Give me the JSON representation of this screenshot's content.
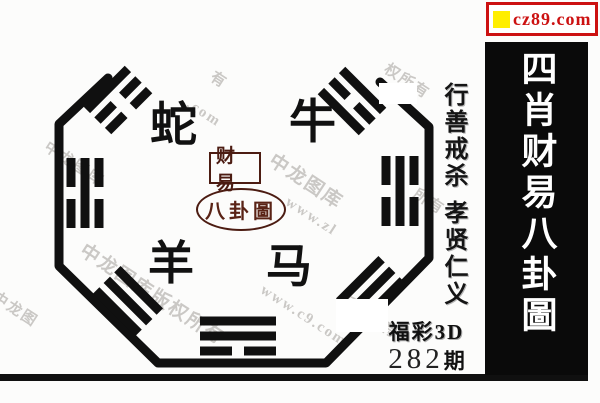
{
  "banner": {
    "site": "cz89.com"
  },
  "title_strip": {
    "text": "四肖财易八卦圖"
  },
  "motto": {
    "part1": "行善戒杀",
    "part2": "孝贤仁义"
  },
  "zodiac": {
    "snake": "蛇",
    "ox": "牛",
    "goat": "羊",
    "horse": "马"
  },
  "seal": {
    "box": "财易",
    "oval": "八卦圖"
  },
  "issue": {
    "game": "福彩3D",
    "number": "282",
    "unit": "期"
  },
  "trigrams": {
    "top_left": [
      "solid",
      "broken",
      "broken"
    ],
    "top_right": [
      "solid",
      "broken",
      "solid"
    ],
    "left_middle": [
      "broken",
      "solid",
      "broken"
    ],
    "right_middle": [
      "broken",
      "solid",
      "broken"
    ],
    "bottom_left": [
      "solid",
      "solid",
      "solid"
    ],
    "bottom_middle": [
      "solid",
      "solid",
      "broken"
    ],
    "bottom_right": [
      "solid",
      "solid",
      "solid"
    ]
  },
  "watermarks": [
    {
      "text": "中龙图库",
      "x": 52,
      "y": 136,
      "big": false
    },
    {
      "text": "有",
      "x": 218,
      "y": 66,
      "big": false
    },
    {
      "text": ".com",
      "x": 192,
      "y": 96,
      "big": false
    },
    {
      "text": "权所有",
      "x": 392,
      "y": 58,
      "big": false
    },
    {
      "text": "中龙图库",
      "x": 279,
      "y": 146,
      "big": true
    },
    {
      "text": "www.zl",
      "x": 291,
      "y": 194,
      "big": false
    },
    {
      "text": "所有",
      "x": 421,
      "y": 183,
      "big": false
    },
    {
      "text": "中龙图库版权所有",
      "x": 90,
      "y": 236,
      "big": true
    },
    {
      "text": "www.c9.com",
      "x": 266,
      "y": 282,
      "big": false
    },
    {
      "text": "版权所有",
      "x": 346,
      "y": 288,
      "big": false
    },
    {
      "text": "中龙图",
      "x": 0,
      "y": 286,
      "big": false
    }
  ]
}
